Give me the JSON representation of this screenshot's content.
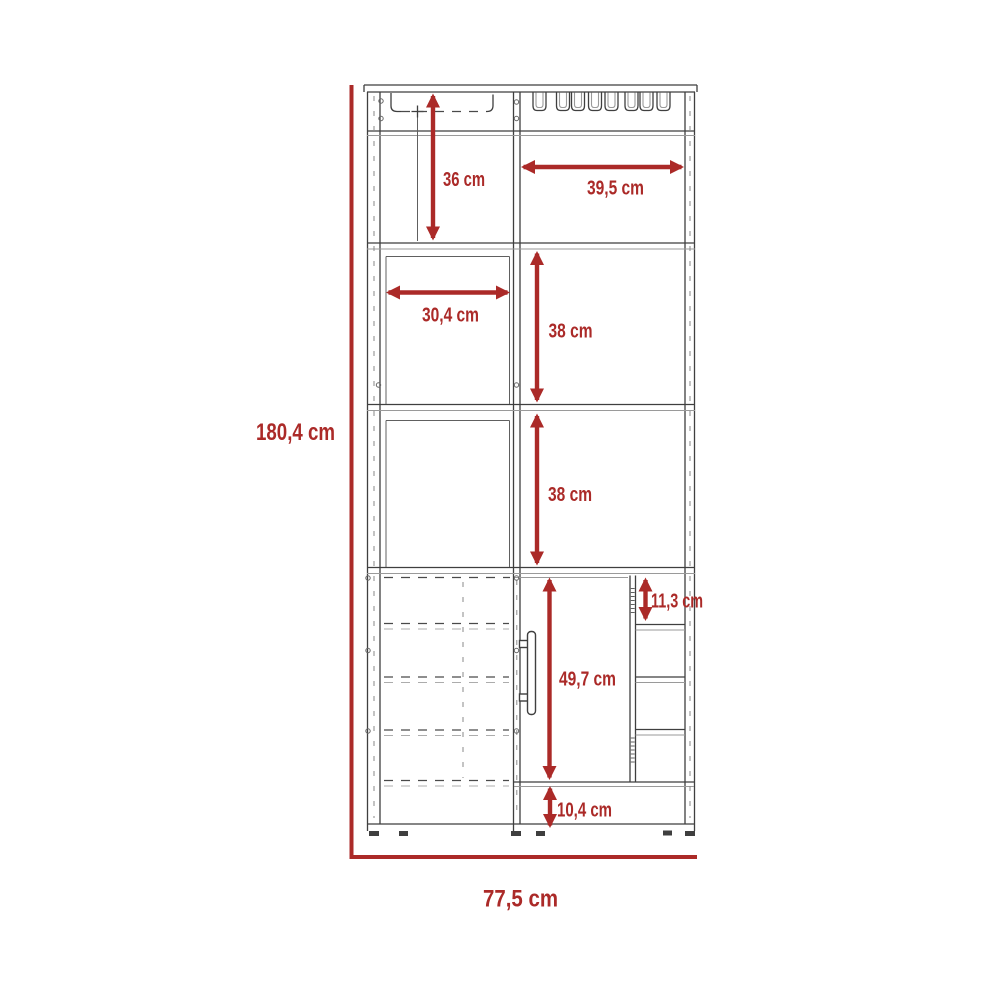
{
  "diagram": {
    "type": "furniture-dimension-drawing",
    "subject": "bar-cabinet-front-elevation",
    "unit": "cm",
    "overall": {
      "height": "180,4 cm",
      "width": "77,5 cm"
    },
    "sections": {
      "top_left_interior_height": "36 cm",
      "top_right_interior_width": "39,5 cm",
      "left_shelf_interior_width": "30,4 cm",
      "right_upper_shelf_height": "38 cm",
      "right_middle_shelf_height": "38 cm",
      "bottle_rack_cubby_height": "11,3 cm",
      "lower_cabinet_interior_height": "49,7 cm",
      "base_plinth_height": "10,4 cm"
    },
    "colors": {
      "dimension_red": "#AB2A28",
      "outline_dark": "#3F3F3F",
      "outline_light": "#9A9A9A",
      "background": "#FFFFFF"
    }
  }
}
